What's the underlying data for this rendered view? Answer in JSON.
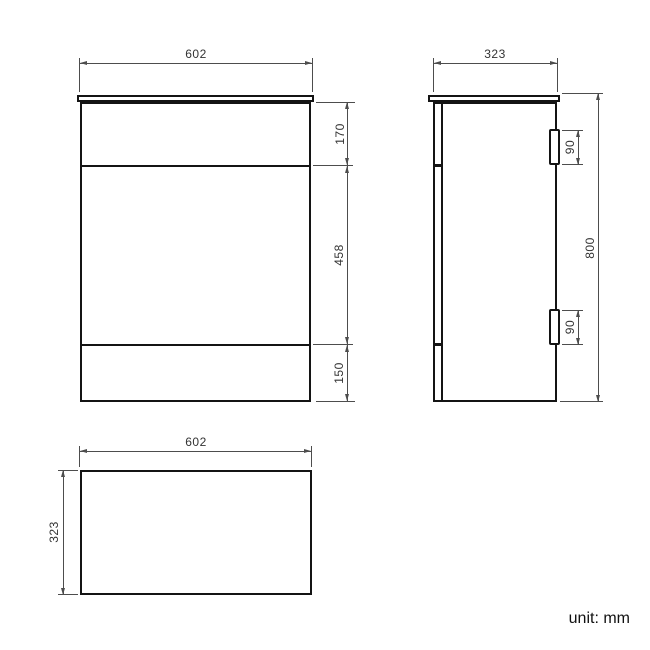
{
  "drawing": {
    "title": "cabinet-dimension-drawing",
    "unit_note": "unit: mm",
    "front_view": {
      "width": "602",
      "sections": {
        "top": "170",
        "middle": "458",
        "bottom": "150"
      }
    },
    "side_view": {
      "depth": "323",
      "height": "800",
      "hinge_top": "90",
      "hinge_bottom": "90"
    },
    "top_view": {
      "width": "602",
      "depth": "323"
    },
    "colors": {
      "outline": "#141414",
      "dimension_line": "#4d4d4d",
      "text": "#333333",
      "background": "#ffffff"
    }
  }
}
